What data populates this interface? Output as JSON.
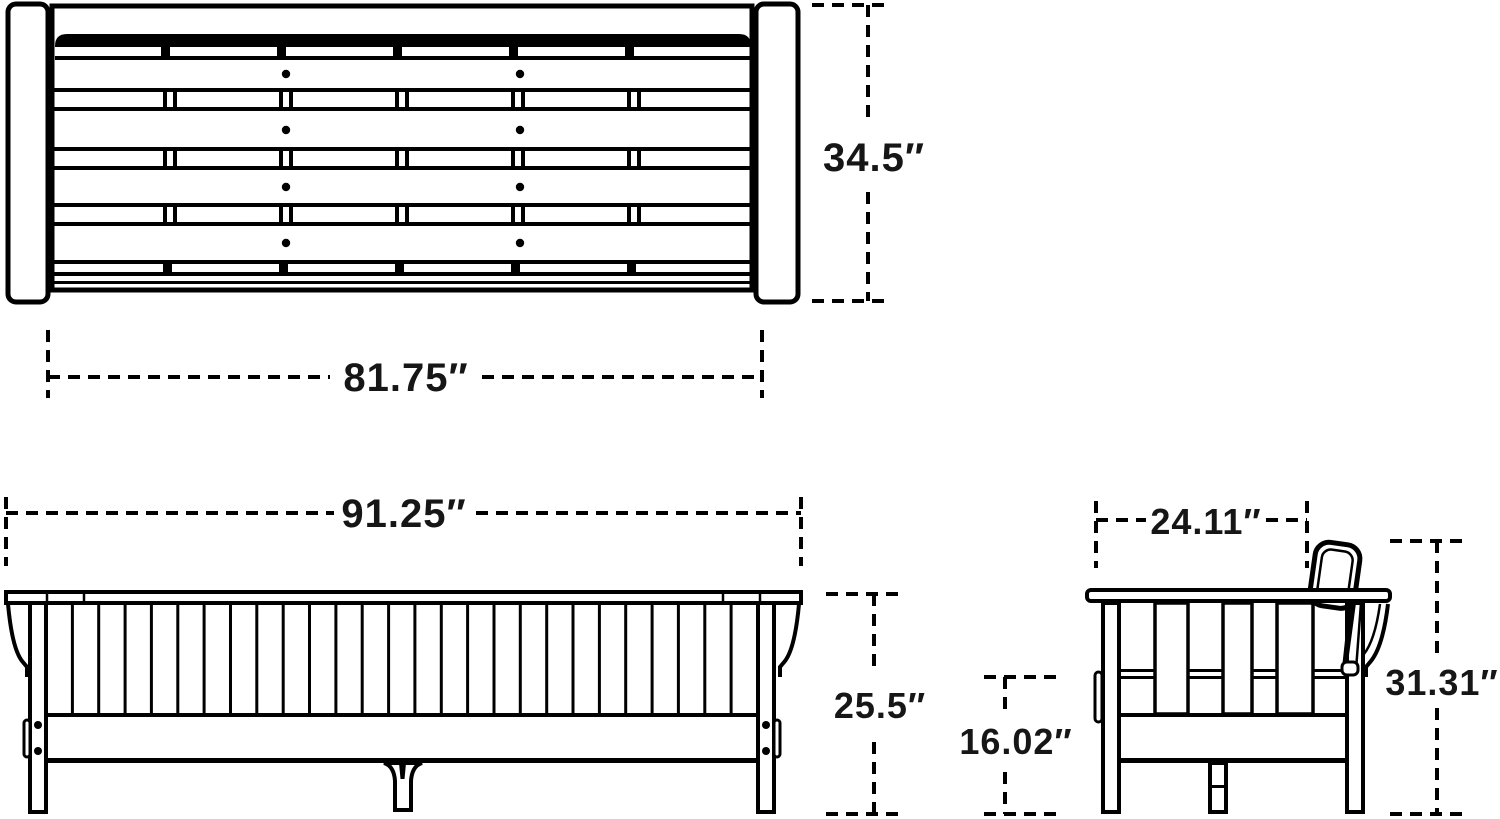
{
  "diagram": {
    "background": "#ffffff",
    "line_color": "#000000",
    "text_color": "#161616",
    "views": {
      "top": {
        "depth_label": "34.5″",
        "width_label": "81.75″"
      },
      "front": {
        "width_label": "91.25″",
        "back_height_label": "25.5″",
        "seat_height_label": "16.02″"
      },
      "side": {
        "depth_label": "24.11″",
        "height_label": "31.31″"
      }
    }
  }
}
